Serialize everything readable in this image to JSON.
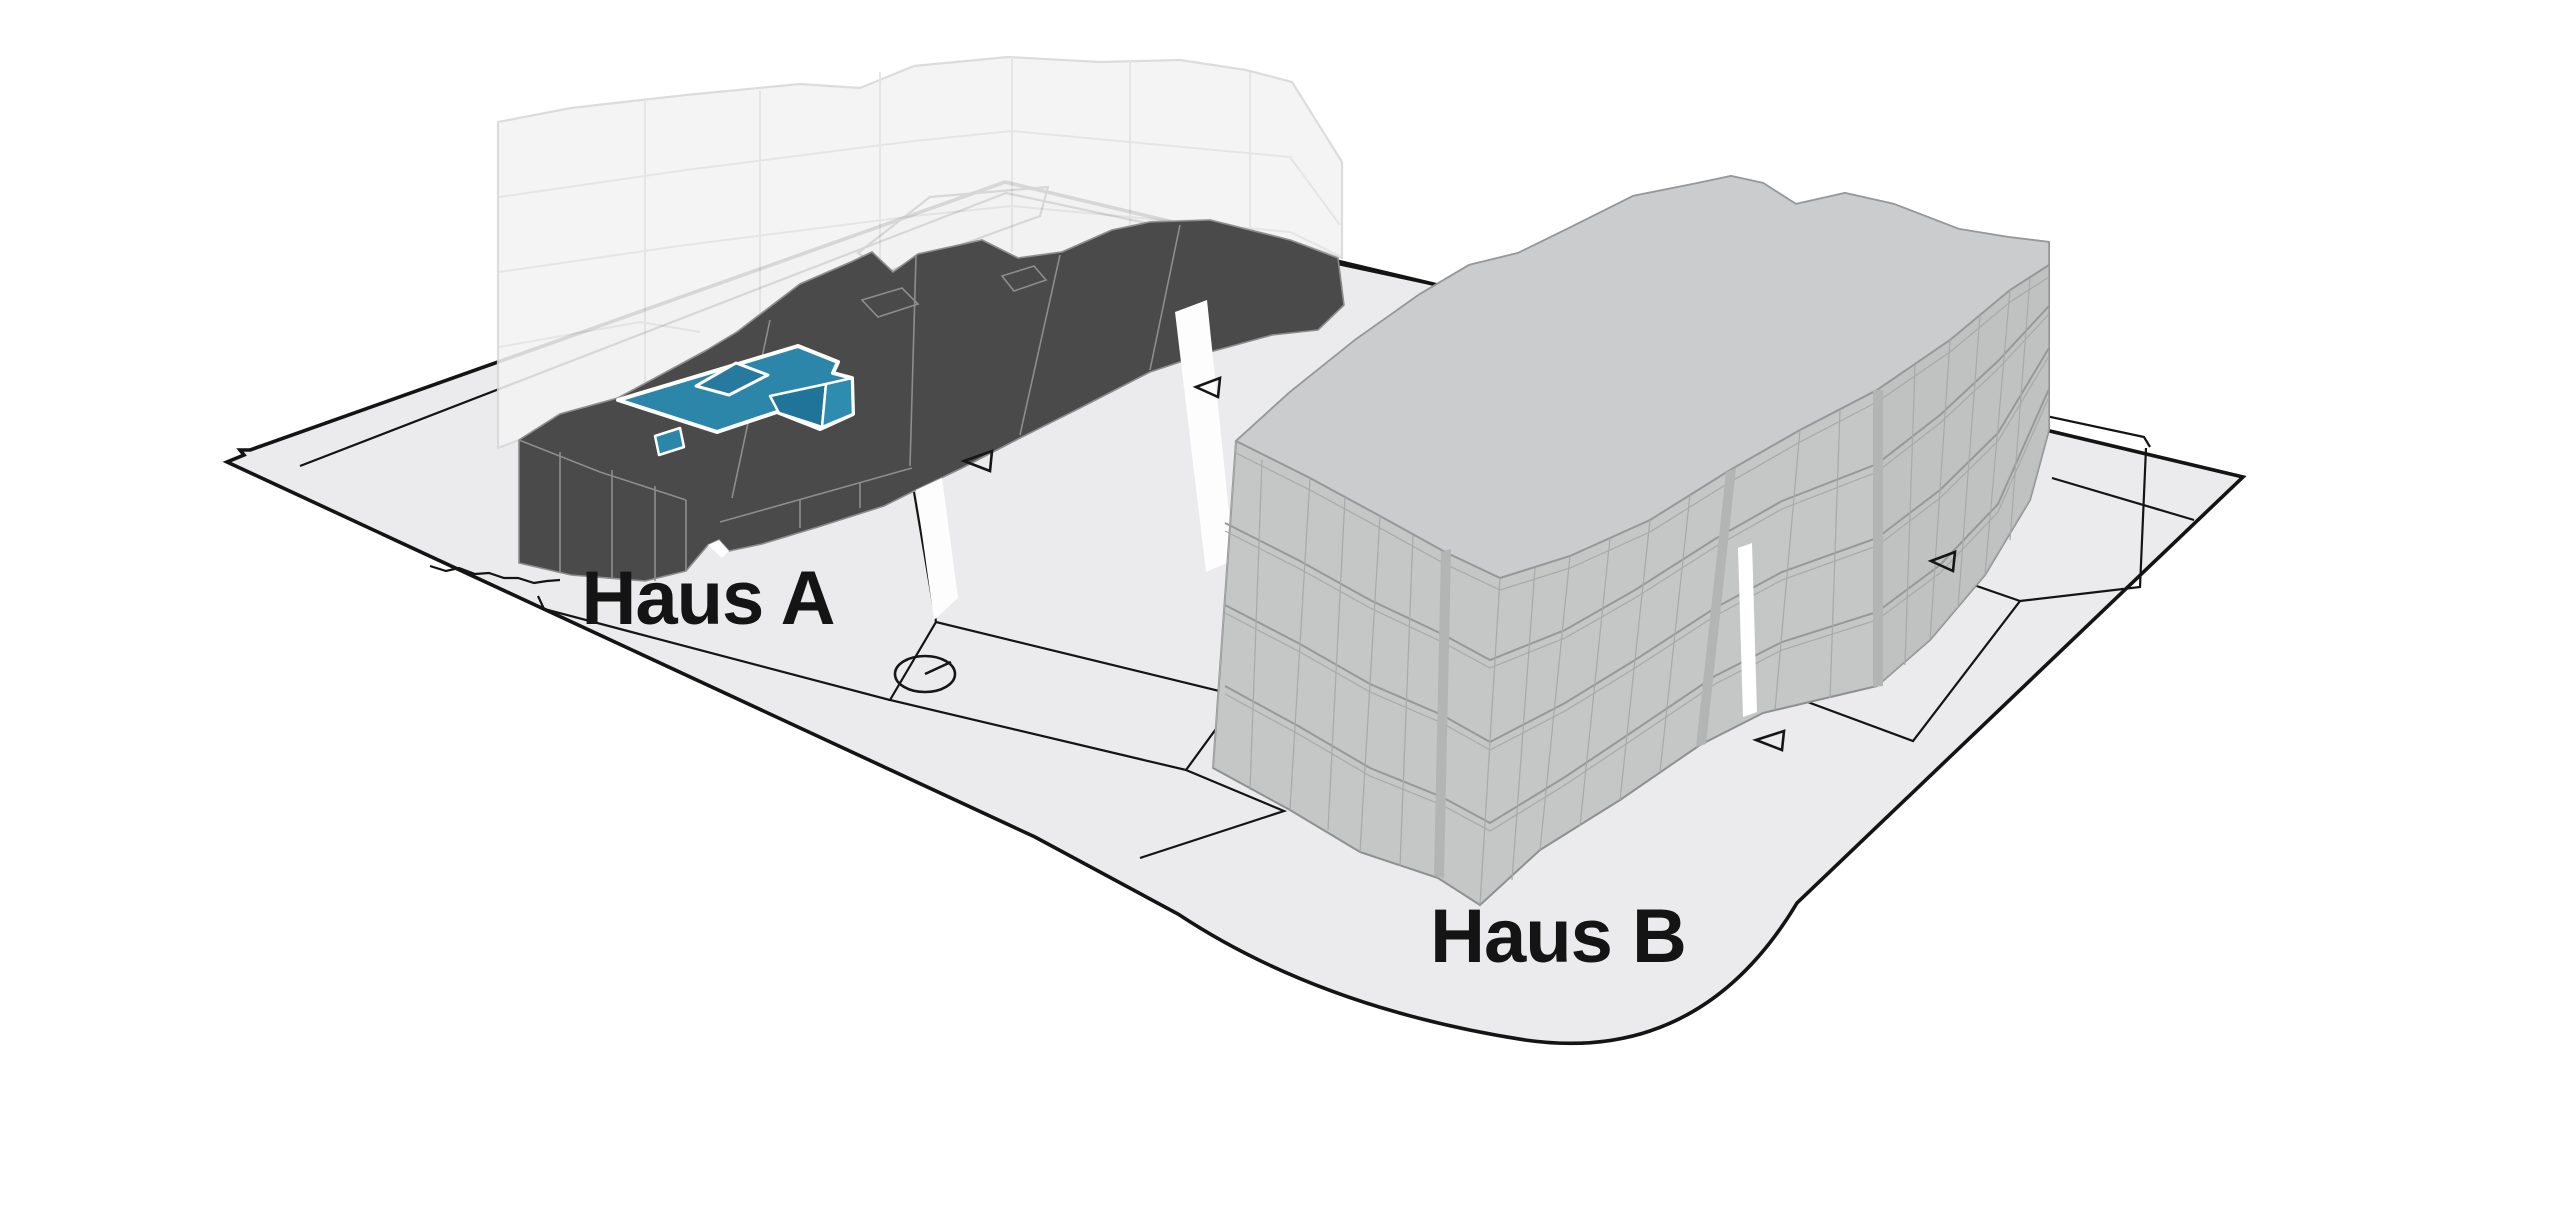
{
  "scene": {
    "type": "architectural-site-diagram",
    "labels": {
      "building_a": "Haus A",
      "building_b": "Haus B"
    },
    "colors": {
      "background": "#ffffff",
      "ground": "#ebebed",
      "boundary_line": "#141414",
      "building_a_body": "#4a4a4a",
      "building_a_edges": "#8d8d8d",
      "highlight_unit": "#2b86a9",
      "highlight_unit_shadow": "#20749a",
      "highlight_unit_light": "#2e8cb0",
      "highlight_outline": "#ffffff",
      "ghost_floors": "#f3f3f4",
      "ghost_stroke": "#d8d8da",
      "building_b_body": "#c5c6c6",
      "building_b_roof": "#cbcccd",
      "building_b_lines": "#97989a",
      "path_fill": "#efeff1"
    },
    "icons": {
      "entrance_markers": [
        {
          "name": "entrance-arrow-icon",
          "x": 978,
          "y": 462
        },
        {
          "name": "entrance-arrow-icon",
          "x": 1208,
          "y": 388
        },
        {
          "name": "entrance-arrow-icon",
          "x": 1943,
          "y": 562
        },
        {
          "name": "entrance-arrow-icon",
          "x": 1770,
          "y": 741
        }
      ],
      "survey_circle": {
        "name": "survey-circle-icon",
        "x": 925,
        "y": 674
      }
    }
  }
}
